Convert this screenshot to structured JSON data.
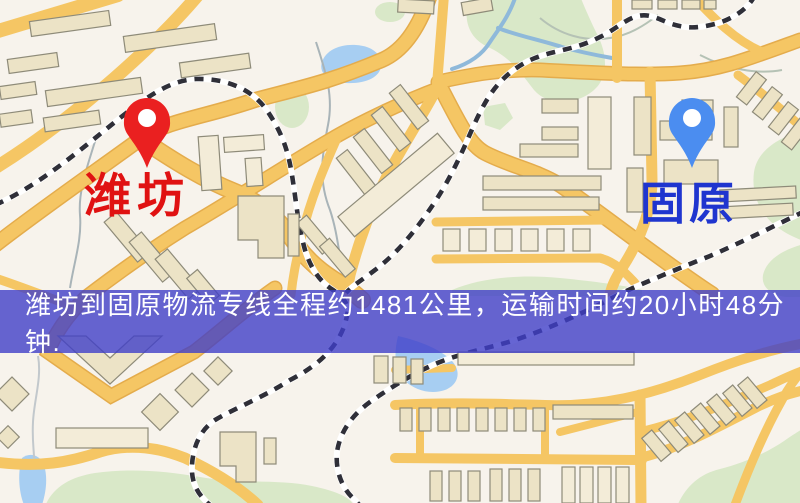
{
  "map": {
    "type": "logistics-route-map",
    "origin": {
      "name": "潍坊",
      "pin_color": "#ea2020",
      "label_color": "#e01212"
    },
    "destination": {
      "name": "固原",
      "pin_color": "#4b8df0",
      "label_color": "#1f35cf"
    },
    "banner": {
      "text": "潍坊到固原物流专线全程约1481公里，运输时间约20小时48分钟.",
      "bg_color": "rgba(64,62,200,0.8)",
      "text_color": "#ffffff"
    },
    "route": {
      "distance_km": 1481,
      "duration_hours": 20,
      "duration_minutes": 48
    },
    "palette": {
      "background": "#f7f3ec",
      "road": "#f5c664",
      "road_casing": "#e4ac4c",
      "building_fill": "#ece3c6",
      "building_stroke": "#8e8b79",
      "park": "#d9e8c8",
      "water": "#a7cef2",
      "railway_dark": "#2f2f38",
      "railway_light": "#ffffff"
    }
  }
}
